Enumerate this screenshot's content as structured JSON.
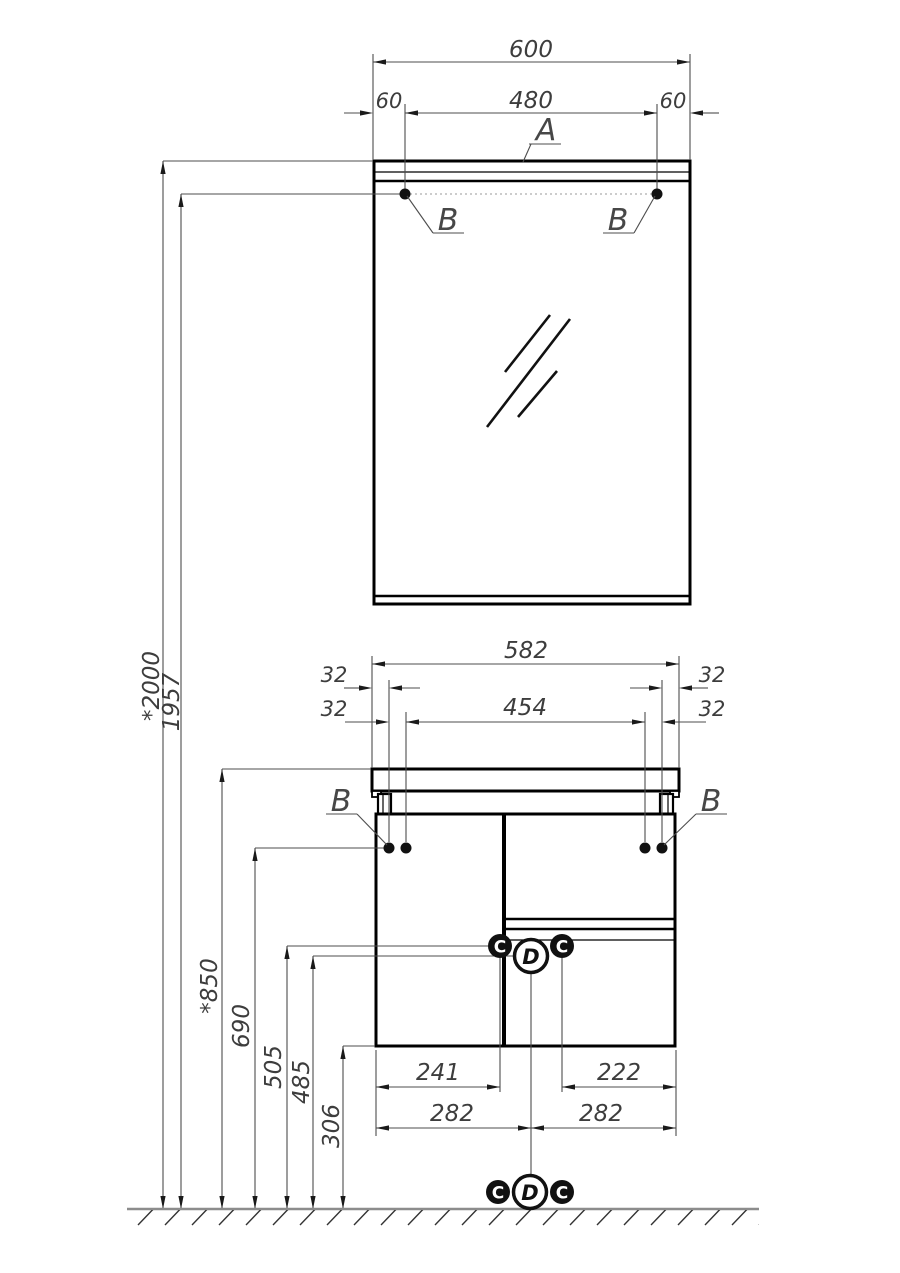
{
  "drawing": {
    "mirror": {
      "width": "600",
      "offset_left": "60",
      "spacing": "480",
      "offset_right": "60",
      "lamp": "A",
      "mount_left": "B",
      "mount_right": "B"
    },
    "cabinet": {
      "width": "582",
      "edge_left": "32",
      "edge_right": "32",
      "pitch_left": "32",
      "pitch_right": "32",
      "spacing": "454",
      "mount_left": "B",
      "mount_right": "B",
      "hinge_left": "C",
      "hinge_right": "C",
      "drain": "D",
      "drain_left": "241",
      "drain_right": "222",
      "half_left": "282",
      "half_right": "282"
    },
    "heights": {
      "total": "*2000",
      "mirror_mounts": "1957",
      "worktop": "*850",
      "cabinet_mounts": "690",
      "hinge": "505",
      "drain": "485",
      "bottom": "306"
    },
    "floor": {
      "hinge_left": "C",
      "drain": "D",
      "hinge_right": "C"
    }
  }
}
